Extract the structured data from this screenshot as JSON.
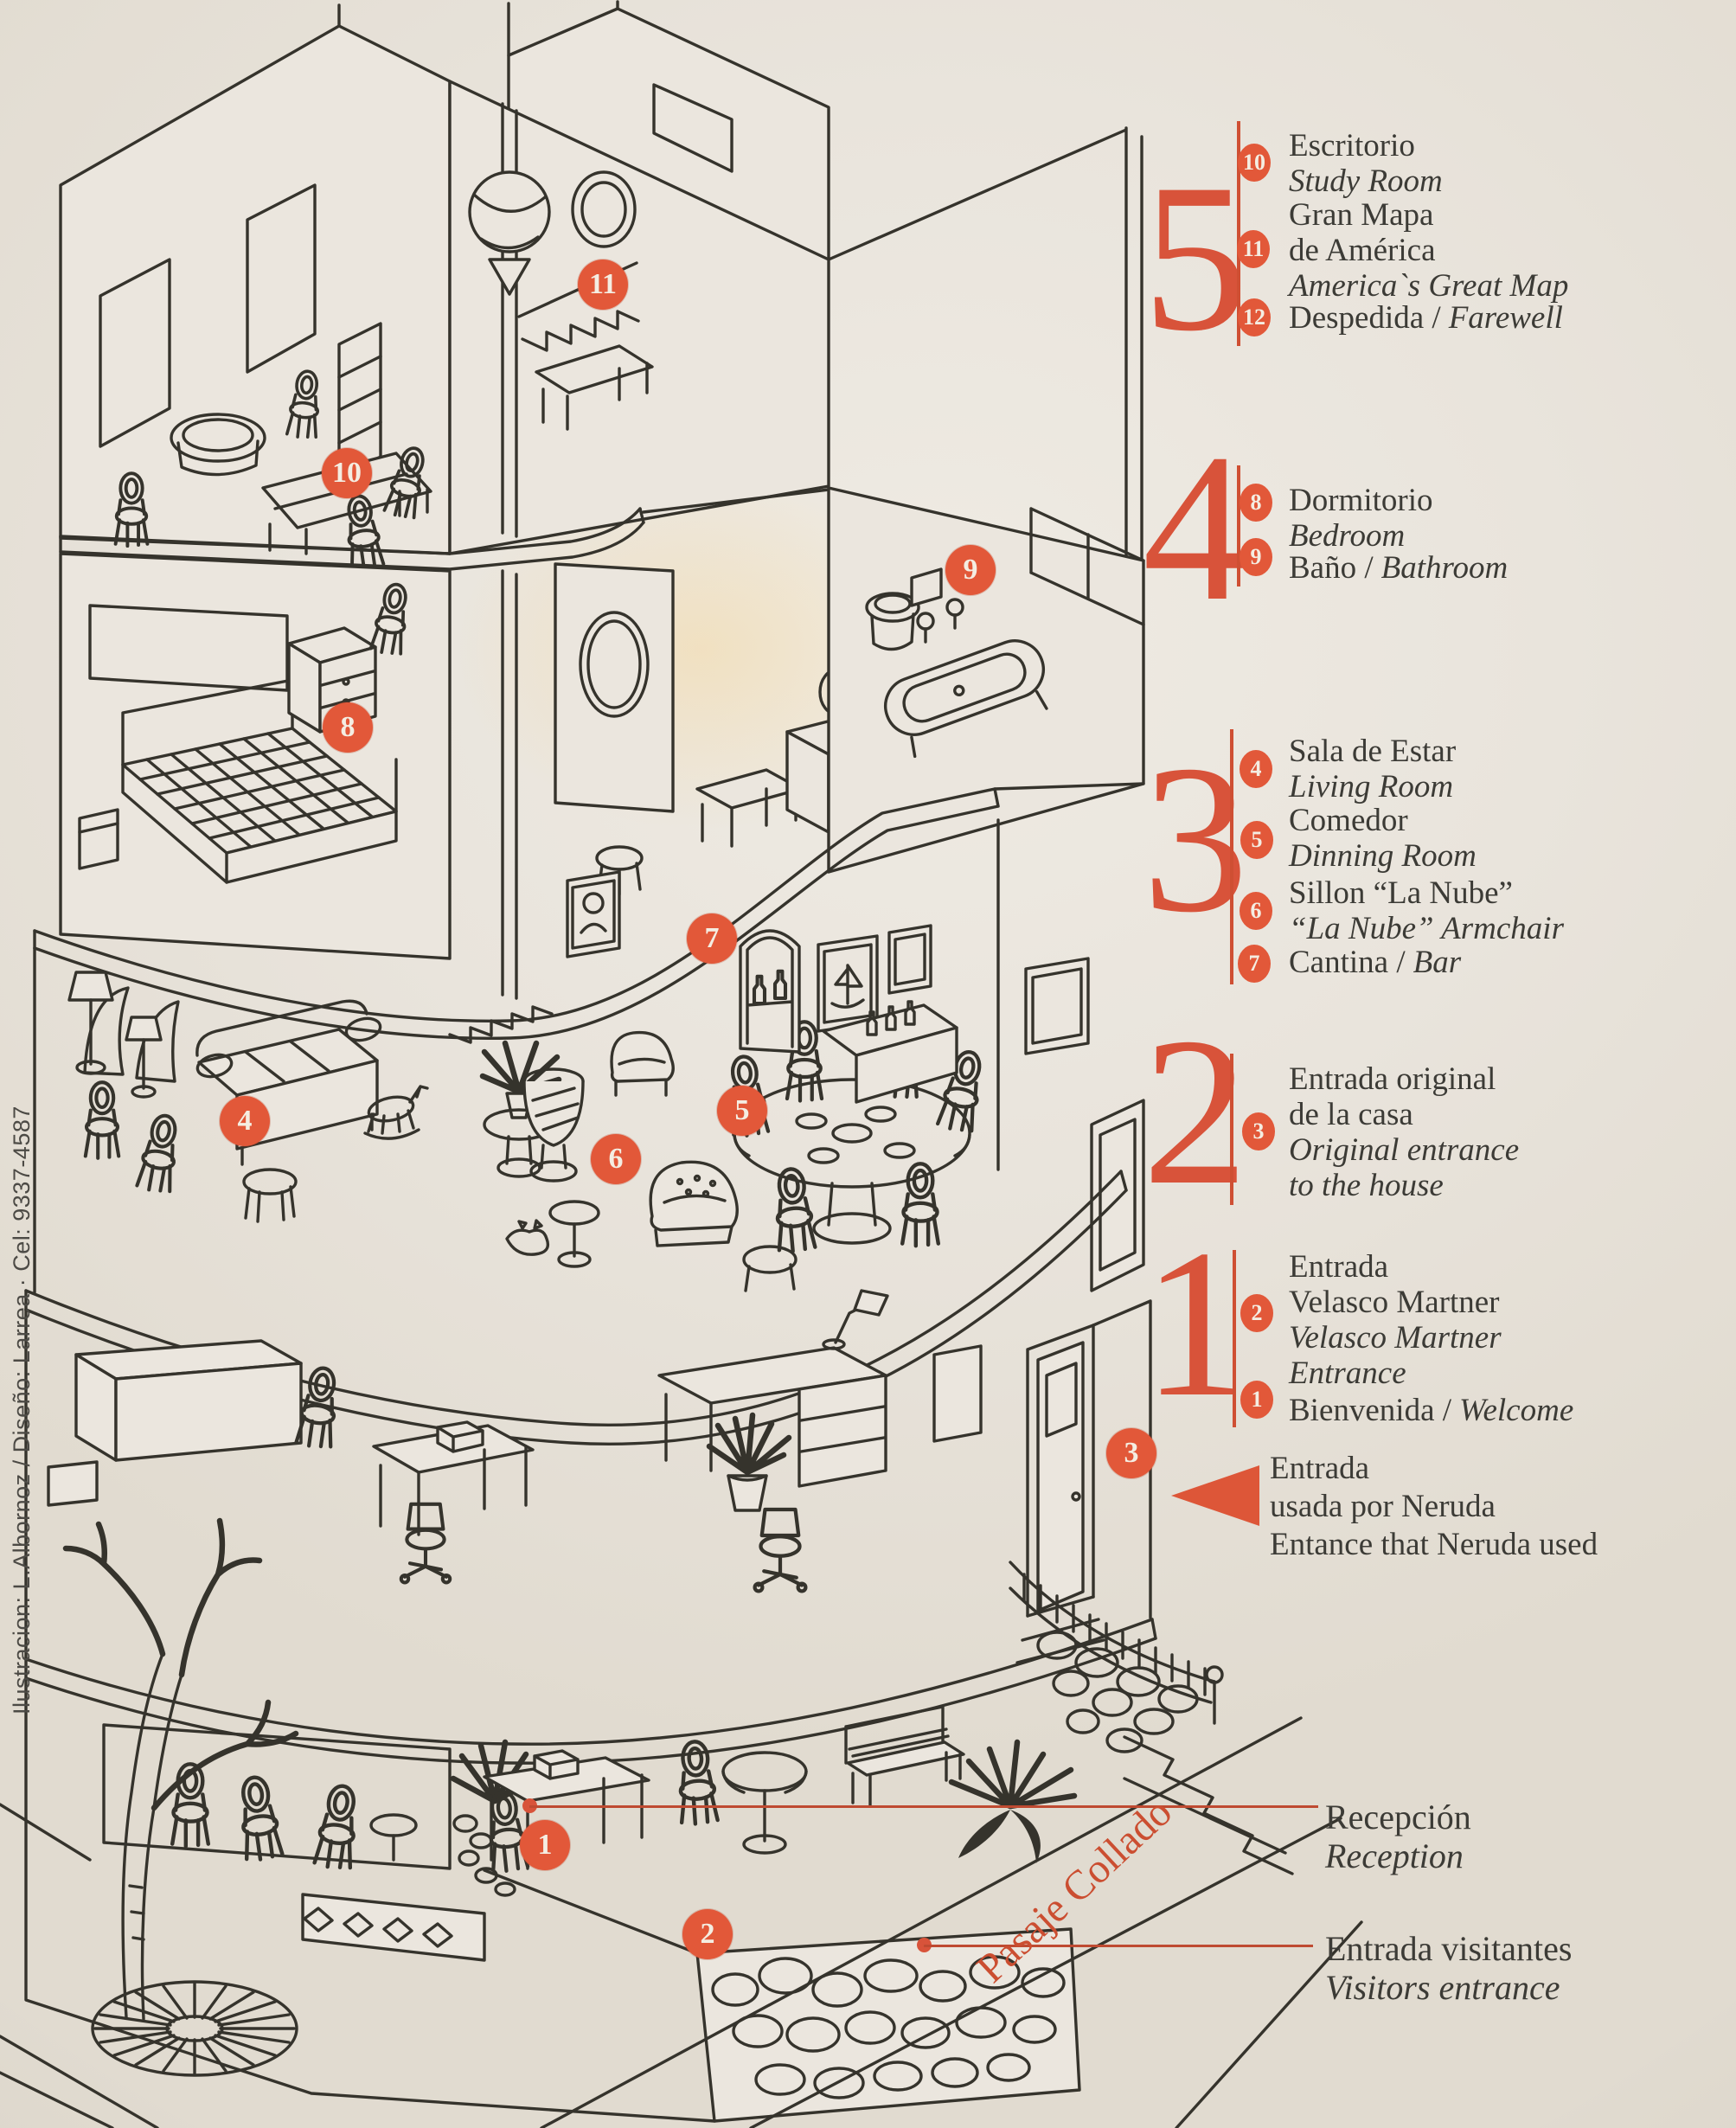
{
  "palette": {
    "paper": "#e9e4dc",
    "ink": "#35332c",
    "orange": "#e25839",
    "orange_deep": "#bf4a31",
    "text": "#3c3b36"
  },
  "credits": "Ilustracion: L.Albornoz / Diseño: Larrea · Cel: 9337-4587",
  "street": {
    "label": "Pasaje Collado"
  },
  "markers": {
    "m1": "1",
    "m2": "2",
    "m3": "3",
    "m4": "4",
    "m5": "5",
    "m6": "6",
    "m7": "7",
    "m8": "8",
    "m9": "9",
    "m10": "10",
    "m11": "11"
  },
  "legend": {
    "floors": [
      {
        "number": "5",
        "items": [
          {
            "badge": "10",
            "line1": "Escritorio",
            "line2": "Study Room"
          },
          {
            "badge": "11",
            "line1": "Gran Mapa",
            "line2": "de América",
            "line3": "America`s Great Map"
          },
          {
            "badge": "12",
            "line1": "Despedida /",
            "line1b": "Farewell"
          }
        ]
      },
      {
        "number": "4",
        "items": [
          {
            "badge": "8",
            "line1": "Dormitorio",
            "line2": "Bedroom"
          },
          {
            "badge": "9",
            "line1": "Baño /",
            "line1b": "Bathroom"
          }
        ]
      },
      {
        "number": "3",
        "items": [
          {
            "badge": "4",
            "line1": "Sala de Estar",
            "line2": "Living Room"
          },
          {
            "badge": "5",
            "line1": "Comedor",
            "line2": "Dinning Room"
          },
          {
            "badge": "6",
            "line1": "Sillon “La Nube”",
            "line2": "“La Nube” Armchair"
          },
          {
            "badge": "7",
            "line1": "Cantina /",
            "line1b": "Bar"
          }
        ]
      },
      {
        "number": "2",
        "items": [
          {
            "badge": "3",
            "line1": "Entrada original",
            "line2": "de la casa",
            "line3": "Original entrance",
            "line4": "to the house"
          }
        ]
      },
      {
        "number": "1",
        "items": [
          {
            "badge": "2",
            "line1": "Entrada",
            "line2": "Velasco Martner",
            "line3": "Velasco Martner",
            "line4": "Entrance"
          },
          {
            "badge": "1",
            "line1": "Bienvenida /",
            "line1b": "Welcome"
          }
        ]
      }
    ],
    "neruda": {
      "line1": "Entrada",
      "line2": "usada por Neruda",
      "line3": "Entance that Neruda used"
    },
    "reception": {
      "line1": "Recepción",
      "line2": "Reception"
    },
    "visitors": {
      "line1": "Entrada visitantes",
      "line2": "Visitors entrance"
    }
  }
}
